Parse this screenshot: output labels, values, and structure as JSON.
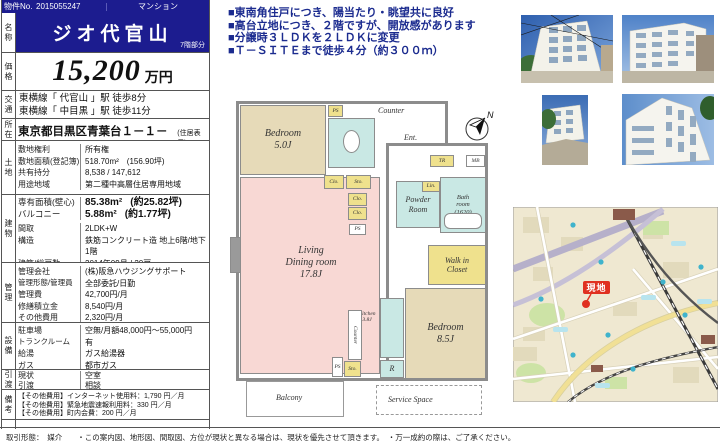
{
  "colors": {
    "navy": "#1c1c8f",
    "highlight_text": "#1b2b8f",
    "room_beige": "#e6dab8",
    "room_pink": "#f8d8d4",
    "room_teal": "#c9e8e4",
    "room_yellow": "#efe18d",
    "wall_gray": "#8c8c8c",
    "map_bg": "#efe8d1",
    "marker_red": "#e03020"
  },
  "header": {
    "no_label": "物件No.",
    "no_value": "2015055247",
    "category": "マンション"
  },
  "highlights": {
    "line1": "■東南角住戸につき、陽当たり・眺望共に良好",
    "line2": "■高台立地につき、２階ですが、開放感があります",
    "line3": "■分譲時３ＬＤＫを２ＬＤＫに変更",
    "line4": "■Ｔ－ＳＩＴＥまで徒歩４分（約３００ｍ）"
  },
  "table": {
    "name": {
      "section": "名称",
      "value": "ジオ代官山",
      "floor_note": "7階部分"
    },
    "price": {
      "section": "価格",
      "value": "15,200",
      "unit": "万円"
    },
    "access": {
      "section": "交通",
      "line1": "東横線「 代官山 」駅 徒歩8分",
      "line2": "東横線「 中目黒 」駅 徒歩11分"
    },
    "location": {
      "section": "所在",
      "value": "東京都目黒区青葉台１－１－４",
      "note": "(住居表示)"
    },
    "land": {
      "section": "土地",
      "rows": [
        {
          "label": "敷地権利",
          "value": "所有権"
        },
        {
          "label": "敷地面積(登記簿)",
          "value": "518.70m²　(156.90坪)"
        },
        {
          "label": "共有持分",
          "value": "8,538 / 147,612"
        },
        {
          "label": "用途地域",
          "value": "第二種中高層住居専用地域"
        }
      ]
    },
    "building": {
      "section": "建物",
      "area_rows": [
        {
          "label": "専有面積(壁心)",
          "value": "85.38m²",
          "note": "(約25.82坪)"
        },
        {
          "label": "バルコニー",
          "value": "5.88m²",
          "note": "(約1.77坪)"
        }
      ],
      "rows": [
        {
          "label": "間取",
          "value": "2LDK+W"
        },
        {
          "label": "構造",
          "value": "鉄筋コンクリート造 地上6階/地下1階"
        },
        {
          "label": "建築/総戸数",
          "value": "2014年09月 / 20戸"
        },
        {
          "label": "分譲会社",
          "value": "阪急不動産(株)"
        },
        {
          "label": "施工会社",
          "value": "木内建設(株)"
        }
      ]
    },
    "management": {
      "section": "管理",
      "rows": [
        {
          "label": "管理会社",
          "value": "(株)阪急ハウジングサポート"
        },
        {
          "label": "管理形態/管理員",
          "value": "全部委託/日勤"
        },
        {
          "label": "管理費",
          "value": "42,700円/月"
        },
        {
          "label": "修繕積立金",
          "value": "8,540円/月"
        },
        {
          "label": "その他費用",
          "value": "2,320円/月"
        },
        {
          "label": "合 計",
          "value": "53,560円/月"
        }
      ]
    },
    "facilities": {
      "section": "設備",
      "rows": [
        {
          "label": "駐車場",
          "value": "空無/月額48,000円～55,000円"
        },
        {
          "label": "トランクルーム",
          "value": "有"
        },
        {
          "label": "給湯",
          "value": "ガス給湯器"
        },
        {
          "label": "ガス",
          "value": "都市ガス"
        },
        {
          "label": "冷暖房",
          "value": "戸別(個別)"
        }
      ]
    },
    "handover": {
      "section": "引渡",
      "rows": [
        {
          "label": "現状",
          "value": "空室"
        },
        {
          "label": "引渡",
          "value": "相談"
        }
      ]
    },
    "notes": {
      "section": "備考",
      "lines": [
        "【その他費用】インターネット使用料：1,790 円／月",
        "【その他費用】緊急地震速報利用料：330 円／月",
        "【その他費用】町内会費：200 円／月"
      ]
    }
  },
  "floorplan": {
    "bedroom1": {
      "name": "Bedroom",
      "size": "5.0J"
    },
    "bedroom2": {
      "name": "Bedroom",
      "size": "8.5J"
    },
    "living": {
      "name": "Living",
      "name2": "Dining room",
      "size": "17.8J"
    },
    "kitchen": {
      "name": "Kitchen",
      "size": "3.8J"
    },
    "labels": {
      "ps": "PS",
      "counter": "Counter",
      "ent": "Ent.",
      "tr": "TR",
      "mb": "MB",
      "clo": "Clo.",
      "sto": "Sto.",
      "lin": "Lin.",
      "powder1": "Powder",
      "powder2": "Room",
      "bath1": "Bath",
      "bath2": "room",
      "bath3": "(1620)",
      "wic1": "Walk in",
      "wic2": "Closet",
      "r": "R",
      "balcony": "Balcony",
      "service": "Service Space",
      "north": "N"
    }
  },
  "map": {
    "marker_label": "現地"
  },
  "footer": {
    "text": "取引形態：　媒介　　・この案内図、地形図、間取図、方位が現状と異なる場合は、現状を優先させて頂きます。　・万一成約の際は、ご了承ください。"
  }
}
